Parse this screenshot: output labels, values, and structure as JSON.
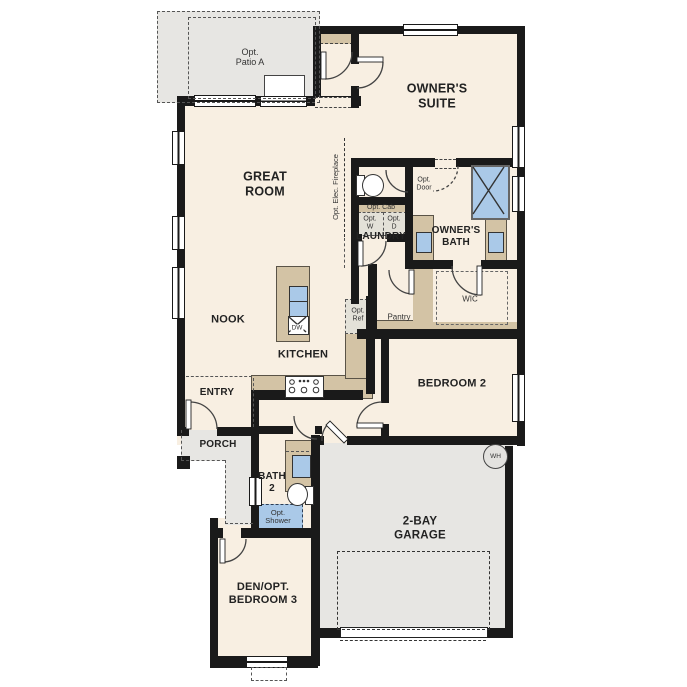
{
  "floor_plan": {
    "rooms": {
      "opt_patio_a": "Opt.\nPatio A",
      "owners_suite": "OWNER'S\nSUITE",
      "great_room": "GREAT\nROOM",
      "laundry": "LAUNDRY",
      "owners_bath": "OWNER'S\nBATH",
      "wic": "WIC",
      "pantry": "Pantry",
      "nook": "NOOK",
      "kitchen": "KITCHEN",
      "bedroom_2": "BEDROOM 2",
      "entry": "ENTRY",
      "porch": "PORCH",
      "bath_2": "BATH\n2",
      "den_opt_bedroom_3": "DEN/OPT.\nBEDROOM 3",
      "garage": "2-BAY\nGARAGE"
    },
    "options": {
      "opt_elec_fireplace": "Opt. Elec. Fireplace",
      "opt_door": "Opt.\nDoor",
      "opt_cab": "Opt. Cab",
      "opt_washer": "Opt.\nW",
      "opt_dryer": "Opt.\nD",
      "opt_ref": "Opt.\nRef",
      "opt_shower": "Opt.\nShower"
    },
    "appliances": {
      "dishwasher": "DW",
      "water_heater": "WH"
    },
    "colors": {
      "wall": "#1a1a1a",
      "floor": "#f8efe2",
      "outdoor": "#e7e6e3",
      "cabinet": "#d3c3a5",
      "fixture": "#aac9e8"
    }
  }
}
